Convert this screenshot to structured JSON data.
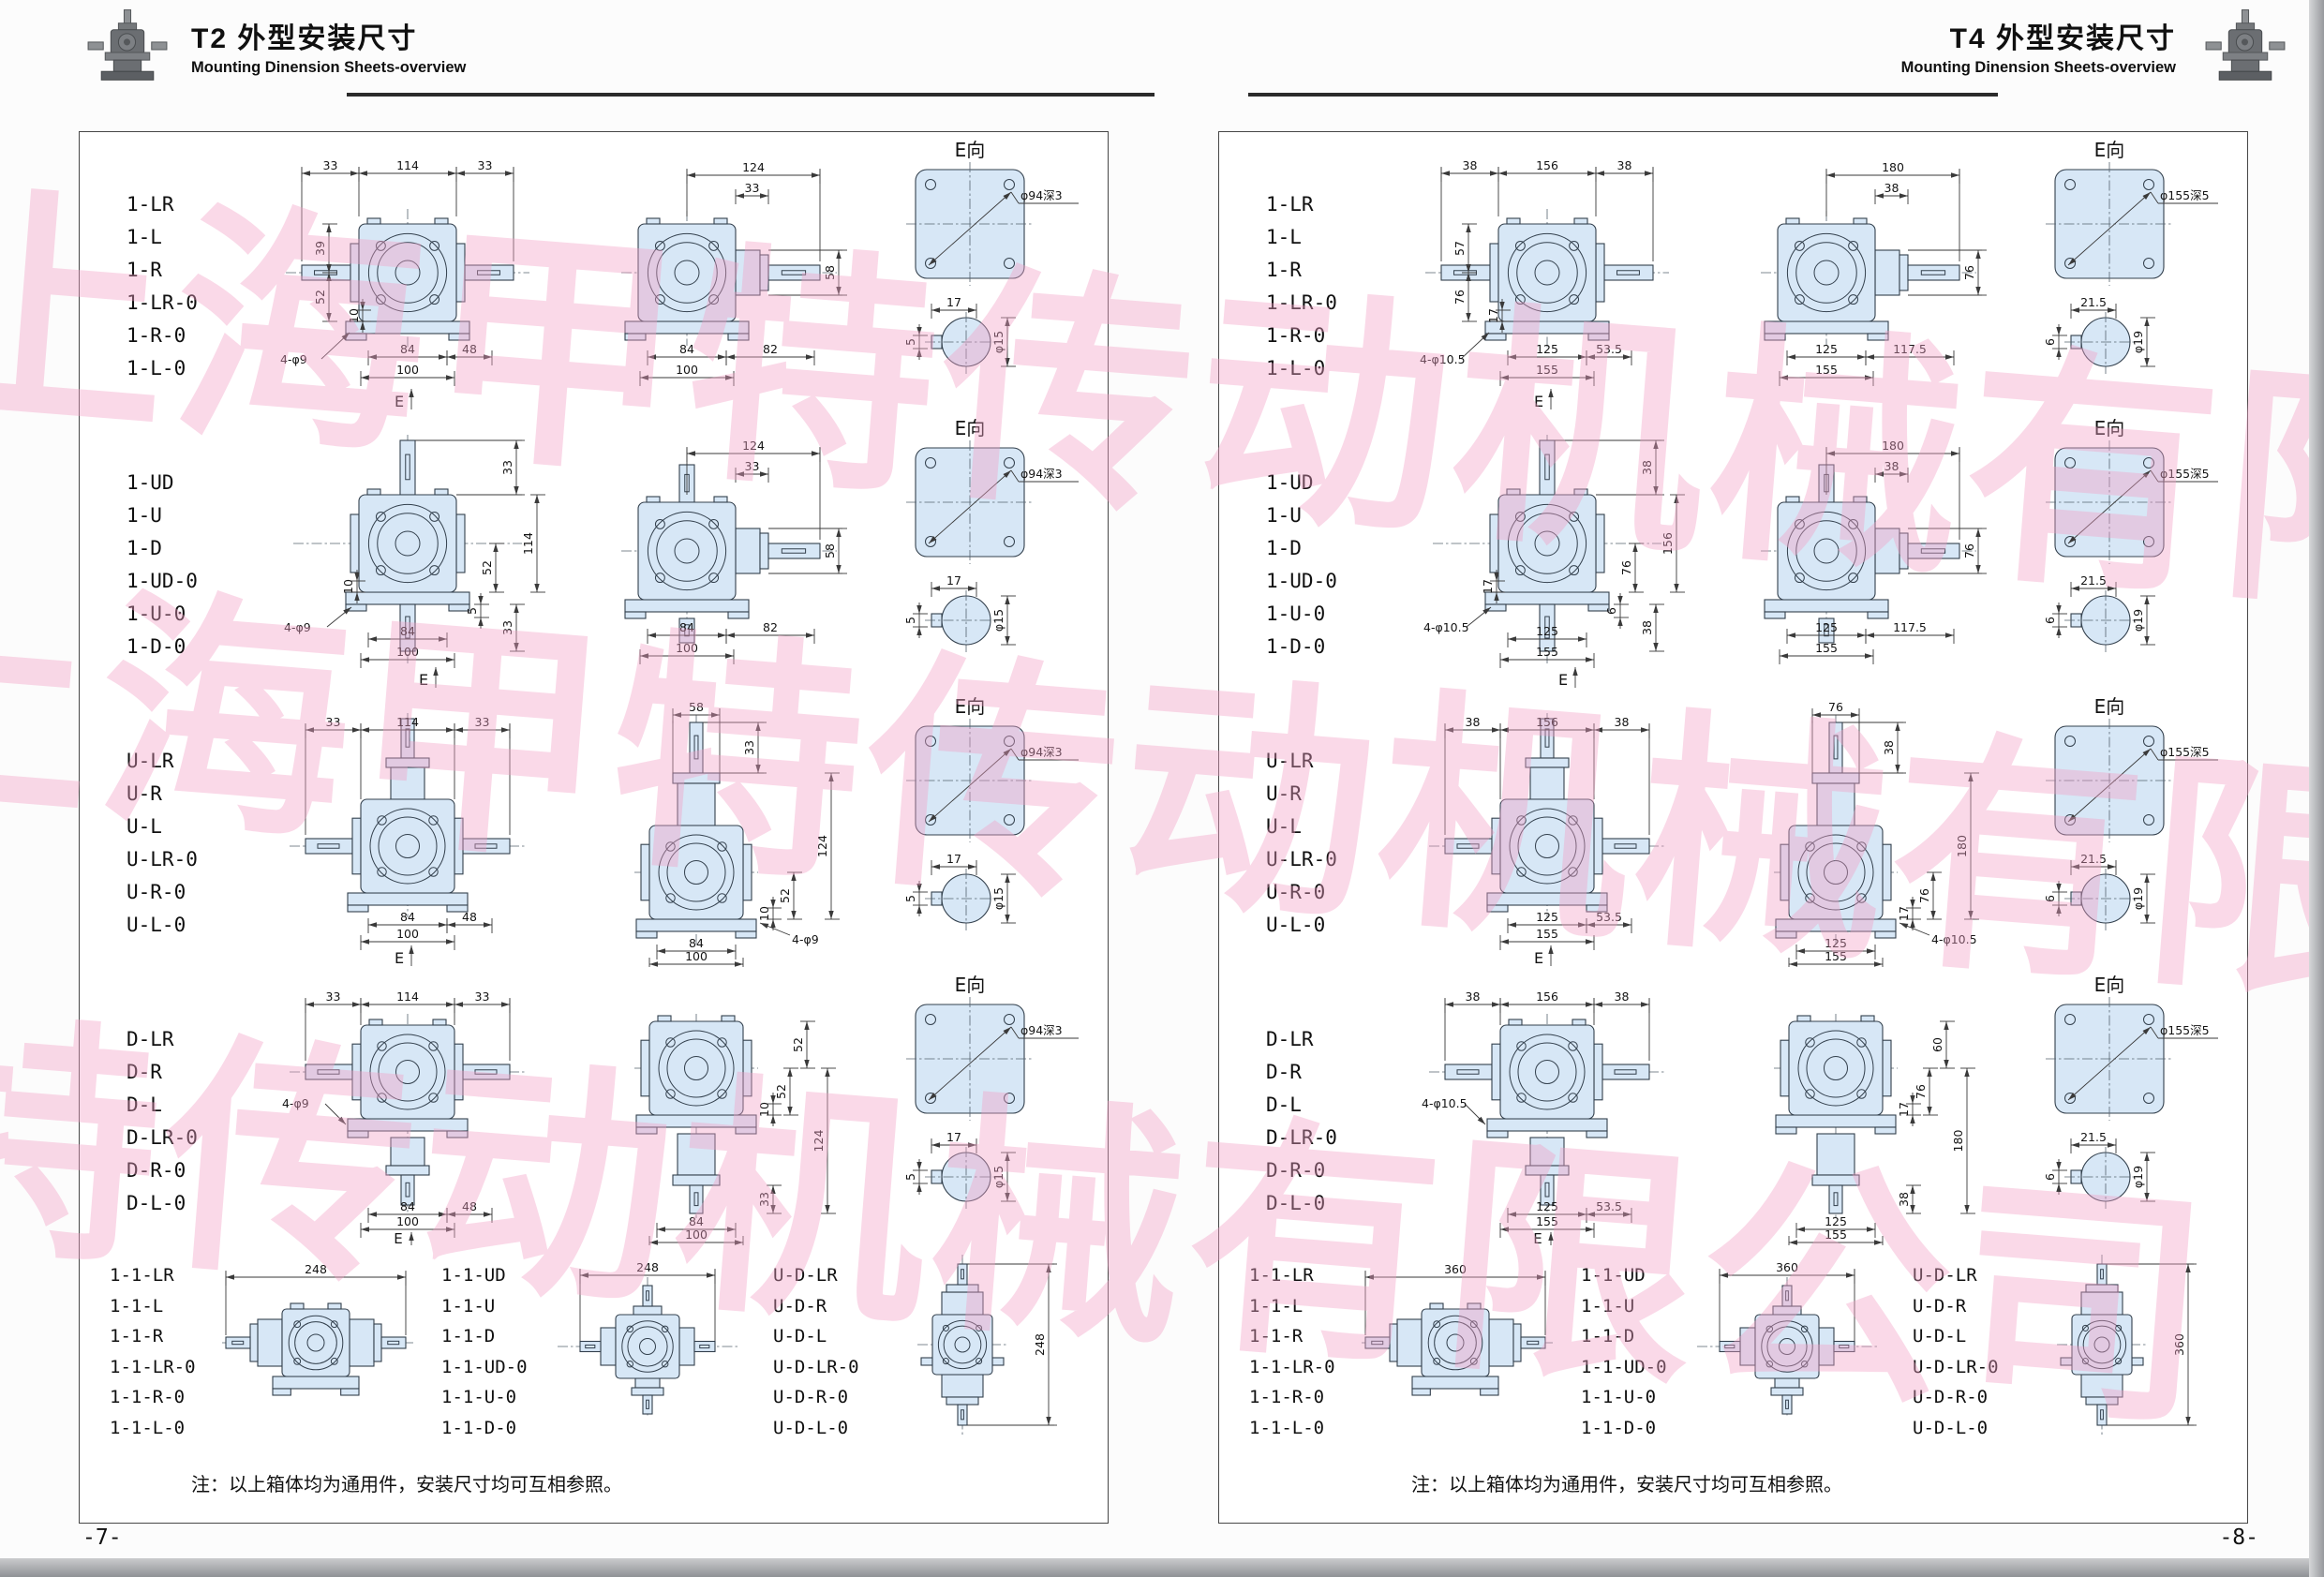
{
  "watermark": {
    "text": "上海甲特传动机械有限公司",
    "color": "#f3a0c5"
  },
  "pages": [
    {
      "header": {
        "title": "T2 外型安装尺寸",
        "subtitle": "Mounting Dinension Sheets-overview"
      },
      "footer": "-7-",
      "note": "注：以上箱体均为通用件，安装尺寸均可互相参照。",
      "rows": [
        {
          "labels": [
            "1-LR",
            "1-L",
            "1-R",
            "1-LR-0",
            "1-R-0",
            "1-L-0"
          ],
          "viewA": {
            "shape": "front-lr",
            "e": "E",
            "top": [
              "33",
              "114",
              "33"
            ],
            "leftV": [
              "39",
              "52"
            ],
            "leftInner": "10",
            "bottom1": [
              "84",
              "48"
            ],
            "bottom2": "100",
            "note": "4-φ9"
          },
          "viewB": {
            "shape": "side-r",
            "top": "124",
            "topSmall": "33",
            "rightV": "58",
            "bottom1": [
              "84",
              "82"
            ],
            "bottom2": "100"
          },
          "eview": {
            "title": "E向",
            "bore": "φ94深3",
            "keyTop": "17",
            "keyLeft": "5",
            "keyDia": "φ15"
          }
        },
        {
          "labels": [
            "1-UD",
            "1-U",
            "1-D",
            "1-UD-0",
            "1-U-0",
            "1-D-0"
          ],
          "viewA": {
            "shape": "front-ud",
            "e": "E",
            "rightTop": "33",
            "rightV": [
              "114",
              "52"
            ],
            "rightBottom": "33",
            "rightSmall": "5",
            "leftInner": "10",
            "bottom1": [
              "84"
            ],
            "bottom2": "100",
            "note": "4-φ9"
          },
          "viewB": {
            "shape": "side-r-ud",
            "top": "124",
            "topSmall": "33",
            "rightV": "58",
            "bottom1": [
              "84",
              "82"
            ],
            "bottom2": "100"
          },
          "eview": {
            "title": "E向",
            "bore": "φ94深3",
            "keyTop": "17",
            "keyLeft": "5",
            "keyDia": "φ15"
          }
        },
        {
          "labels": [
            "U-LR",
            "U-R",
            "U-L",
            "U-LR-0",
            "U-R-0",
            "U-L-0"
          ],
          "viewA": {
            "shape": "front-up-lr",
            "e": "E",
            "top": [
              "33",
              "114",
              "33"
            ],
            "bottom1": [
              "84",
              "48"
            ],
            "bottom2": "100"
          },
          "viewB": {
            "shape": "tower-up",
            "top": "58",
            "rightTop": "33",
            "rightV": "124",
            "midSmall": [
              "10",
              "52"
            ],
            "note": "4-φ9",
            "bottom1": [
              "84"
            ],
            "bottom2": "100"
          },
          "eview": {
            "title": "E向",
            "bore": "φ94深3",
            "keyTop": "17",
            "keyLeft": "5",
            "keyDia": "φ15"
          }
        },
        {
          "labels": [
            "D-LR",
            "D-R",
            "D-L",
            "D-LR-0",
            "D-R-0",
            "D-L-0"
          ],
          "viewA": {
            "shape": "front-down-lr",
            "e": "E",
            "top": [
              "33",
              "114",
              "33"
            ],
            "note": "4-φ9",
            "bottom1": [
              "84",
              "48"
            ],
            "bottom2": "100"
          },
          "viewB": {
            "shape": "tower-down",
            "rightTop": "52",
            "midSmall": [
              "10",
              "52"
            ],
            "rightOuter": "124",
            "rightLower": "33",
            "bottom1": [
              "84"
            ],
            "bottom2": "100"
          },
          "eview": {
            "title": "E向",
            "bore": "φ94深3",
            "keyTop": "17",
            "keyLeft": "5",
            "keyDia": "φ15"
          }
        }
      ],
      "row5": {
        "groups": [
          {
            "labels": [
              "1-1-LR",
              "1-1-L",
              "1-1-R",
              "1-1-LR-0",
              "1-1-R-0",
              "1-1-L-0"
            ],
            "shape": "double-h",
            "dim": "248"
          },
          {
            "labels": [
              "1-1-UD",
              "1-1-U",
              "1-1-D",
              "1-1-UD-0",
              "1-1-U-0",
              "1-1-D-0"
            ],
            "shape": "cross4",
            "dim": "248"
          },
          {
            "labels": [
              "U-D-LR",
              "U-D-R",
              "U-D-L",
              "U-D-LR-0",
              "U-D-R-0",
              "U-D-L-0"
            ],
            "shape": "double-v",
            "dim": "248"
          }
        ]
      }
    },
    {
      "header": {
        "title": "T4 外型安装尺寸",
        "subtitle": "Mounting Dinension Sheets-overview"
      },
      "footer": "-8-",
      "note": "注：以上箱体均为通用件，安装尺寸均可互相参照。",
      "rows": [
        {
          "labels": [
            "1-LR",
            "1-L",
            "1-R",
            "1-LR-0",
            "1-R-0",
            "1-L-0"
          ],
          "viewA": {
            "shape": "front-lr",
            "e": "E",
            "top": [
              "38",
              "156",
              "38"
            ],
            "leftV": [
              "57",
              "76"
            ],
            "leftInner": "17",
            "bottom1": [
              "125",
              "53.5"
            ],
            "bottom2": "155",
            "note": "4-φ10.5"
          },
          "viewB": {
            "shape": "side-r",
            "top": "180",
            "topSmall": "38",
            "rightV": "76",
            "bottom1": [
              "125",
              "117.5"
            ],
            "bottom2": "155"
          },
          "eview": {
            "title": "E向",
            "bore": "φ155深5",
            "keyTop": "21.5",
            "keyLeft": "6",
            "keyDia": "φ19"
          }
        },
        {
          "labels": [
            "1-UD",
            "1-U",
            "1-D",
            "1-UD-0",
            "1-U-0",
            "1-D-0"
          ],
          "viewA": {
            "shape": "front-ud",
            "e": "E",
            "rightTop": "38",
            "rightV": [
              "156",
              "76"
            ],
            "rightBottom": "38",
            "rightSmall": "6",
            "leftInner": "17",
            "bottom1": [
              "125"
            ],
            "bottom2": "155",
            "note": "4-φ10.5"
          },
          "viewB": {
            "shape": "side-r-ud",
            "top": "180",
            "topSmall": "38",
            "rightV": "76",
            "bottom1": [
              "125",
              "117.5"
            ],
            "bottom2": "155"
          },
          "eview": {
            "title": "E向",
            "bore": "φ155深5",
            "keyTop": "21.5",
            "keyLeft": "6",
            "keyDia": "φ19"
          }
        },
        {
          "labels": [
            "U-LR",
            "U-R",
            "U-L",
            "U-LR-0",
            "U-R-0",
            "U-L-0"
          ],
          "viewA": {
            "shape": "front-up-lr",
            "e": "E",
            "top": [
              "38",
              "156",
              "38"
            ],
            "bottom1": [
              "125",
              "53.5"
            ],
            "bottom2": "155"
          },
          "viewB": {
            "shape": "tower-up",
            "top": "76",
            "rightTop": "38",
            "rightV": "180",
            "midSmall": [
              "17",
              "76"
            ],
            "note": "4-φ10.5",
            "bottom1": [
              "125"
            ],
            "bottom2": "155"
          },
          "eview": {
            "title": "E向",
            "bore": "φ155深5",
            "keyTop": "21.5",
            "keyLeft": "6",
            "keyDia": "φ19"
          }
        },
        {
          "labels": [
            "D-LR",
            "D-R",
            "D-L",
            "D-LR-0",
            "D-R-0",
            "D-L-0"
          ],
          "viewA": {
            "shape": "front-down-lr",
            "e": "E",
            "top": [
              "38",
              "156",
              "38"
            ],
            "note": "4-φ10.5",
            "bottom1": [
              "125",
              "53.5"
            ],
            "bottom2": "155"
          },
          "viewB": {
            "shape": "tower-down",
            "rightTop": "60",
            "midSmall": [
              "17",
              "76"
            ],
            "rightOuter": "180",
            "rightLower": "38",
            "bottom1": [
              "125"
            ],
            "bottom2": "155"
          },
          "eview": {
            "title": "E向",
            "bore": "φ155深5",
            "keyTop": "21.5",
            "keyLeft": "6",
            "keyDia": "φ19"
          }
        }
      ],
      "row5": {
        "groups": [
          {
            "labels": [
              "1-1-LR",
              "1-1-L",
              "1-1-R",
              "1-1-LR-0",
              "1-1-R-0",
              "1-1-L-0"
            ],
            "shape": "double-h",
            "dim": "360"
          },
          {
            "labels": [
              "1-1-UD",
              "1-1-U",
              "1-1-D",
              "1-1-UD-0",
              "1-1-U-0",
              "1-1-D-0"
            ],
            "shape": "cross4",
            "dim": "360"
          },
          {
            "labels": [
              "U-D-LR",
              "U-D-R",
              "U-D-L",
              "U-D-LR-0",
              "U-D-R-0",
              "U-D-L-0"
            ],
            "shape": "double-v",
            "dim": "360"
          }
        ]
      }
    }
  ]
}
